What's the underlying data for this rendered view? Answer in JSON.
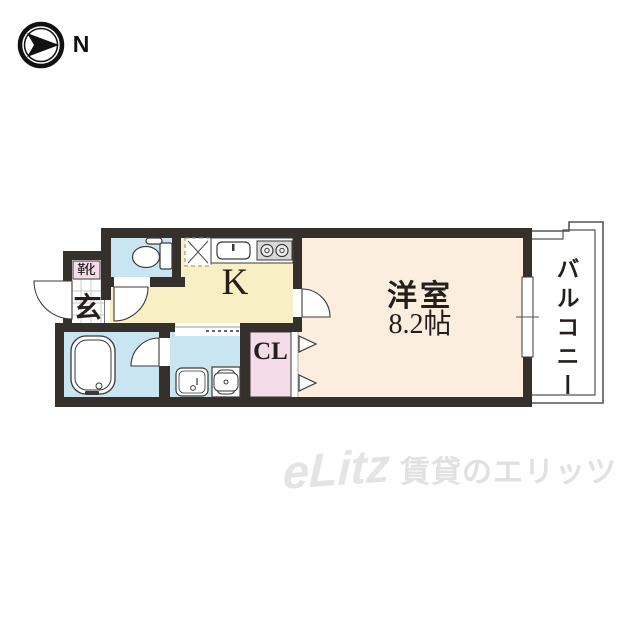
{
  "compass": {
    "direction_label": "N"
  },
  "plan": {
    "kitchen_label": "K",
    "western_room_label": "洋室",
    "western_room_size": "8.2帖",
    "balcony_label": "バルコニー",
    "closet_label": "CL",
    "entrance_label": "玄",
    "shoe_cabinet_label": "靴",
    "colors": {
      "wall": "#35302c",
      "wet_rooms": "#c9e5f2",
      "kitchen": "#f9efc5",
      "western_room": "#fceede",
      "closet": "#f4dce8",
      "entrance_tile": "#ffffff"
    },
    "fixtures": [
      "toilet",
      "refrigerator-space",
      "kitchen-sink",
      "gas-stove-2-burner",
      "bathtub",
      "washbasin",
      "washing-machine-pan",
      "closet-folding-doors",
      "sliding-window",
      "entrance-door"
    ]
  },
  "watermark": {
    "logo_text": "eLitz",
    "brand_text": "賃貸のエリッツ"
  }
}
